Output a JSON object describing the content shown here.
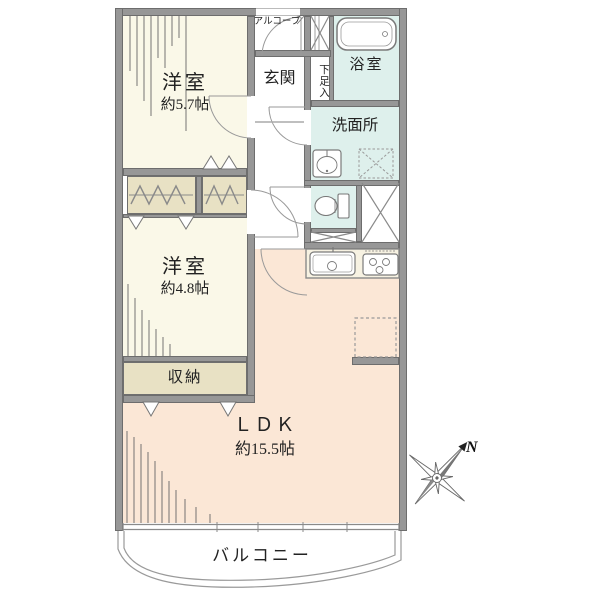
{
  "rooms": {
    "bedroom1": {
      "name": "洋室",
      "size": "約5.7帖"
    },
    "bedroom2": {
      "name": "洋室",
      "size": "約4.8帖"
    },
    "ldk": {
      "name": "ＬＤＫ",
      "size": "約15.5帖"
    },
    "entrance": {
      "name": "玄関"
    },
    "alcove": {
      "name": "アルコーブ"
    },
    "shoe_cabinet": {
      "name": "下足入"
    },
    "bathroom": {
      "name": "浴室"
    },
    "washroom": {
      "name": "洗面所"
    },
    "storage": {
      "name": "収納"
    },
    "balcony": {
      "name": "バルコニー"
    }
  },
  "compass": {
    "north_label": "N"
  },
  "colors": {
    "wall_gray": "#979797",
    "room_cream": "#faf8e8",
    "closet_beige": "#e8e1c4",
    "ldk_pink": "#fbe7d6",
    "wet_area_blue": "#def0ec",
    "counter_beige": "#f7f2e2",
    "line_gray": "#8a8a8a",
    "text_dark": "#222222"
  }
}
